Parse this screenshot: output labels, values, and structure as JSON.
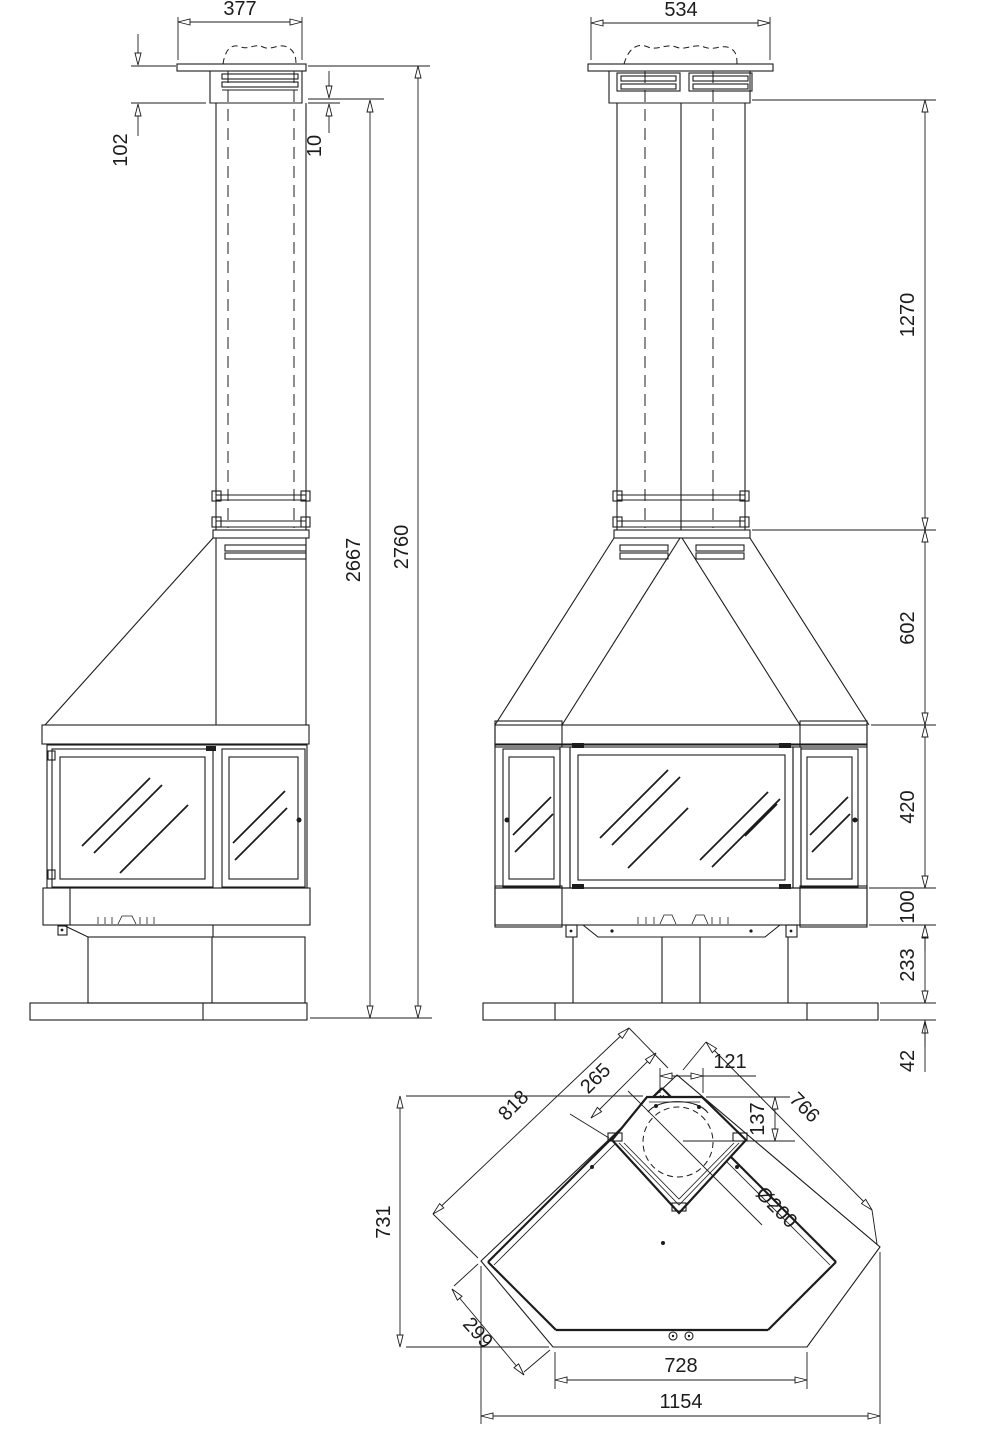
{
  "side_view": {
    "cap_width": "377",
    "cap_height": "102",
    "cap_overlap": "10",
    "body_height": "2667",
    "total_height": "2760"
  },
  "front_view": {
    "cap_width": "534",
    "flue_height": "1270",
    "hood_height": "602",
    "firebox_height": "420",
    "base_height": "100",
    "pedestal_height": "233",
    "floor_plate_height": "42"
  },
  "plan_view": {
    "flue_opening_width": "121",
    "flue_center_depth": "137",
    "corner_to_flue": "265",
    "left_side": "818",
    "right_side": "766",
    "depth": "731",
    "chamfer": "299",
    "front_width": "728",
    "overall_width": "1154",
    "flue_diameter": "Ø200"
  }
}
